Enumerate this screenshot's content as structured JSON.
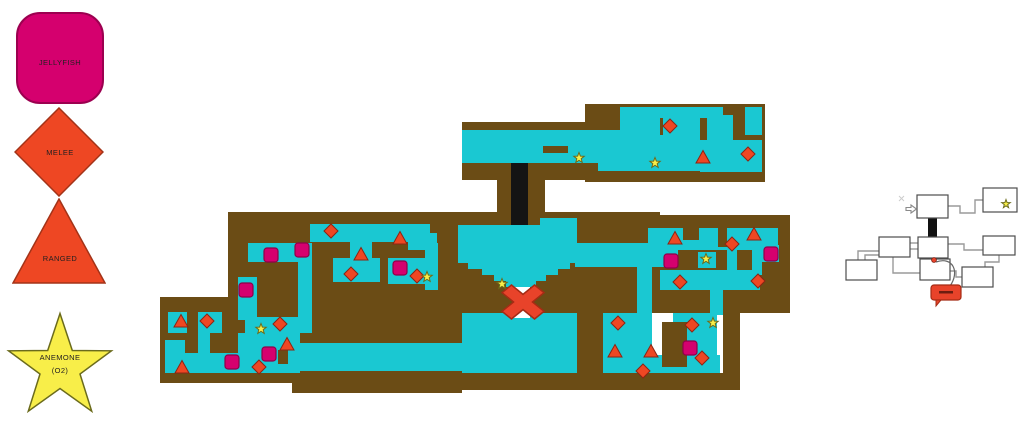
{
  "legend": {
    "items": [
      {
        "id": "jellyfish",
        "label": "JELLYFISH",
        "shape": "rounded-square",
        "color_key": "jellyfish"
      },
      {
        "id": "melee",
        "label": "MELEE",
        "shape": "diamond",
        "color_key": "enemy"
      },
      {
        "id": "ranged",
        "label": "RANGED",
        "shape": "triangle",
        "color_key": "enemy"
      },
      {
        "id": "anemone",
        "label": "ANEMONE",
        "sublabel": "(O2)",
        "shape": "star",
        "color_key": "anemone"
      }
    ]
  },
  "map": {
    "palette": {
      "land": "#6b4c15",
      "water": "#1ac8d2",
      "shaft": "#141414",
      "hole": "#ffffff",
      "jellyfish": "#d5006e",
      "jellyfish_border": "#8e0048",
      "enemy": "#ee4723",
      "enemy_border": "#8c2413",
      "anemone": "#f8ee49",
      "anemone_border": "#6b6b1c",
      "boss": "#e8432a",
      "boss_border": "#a52b14",
      "box_border": "#4d4d4d",
      "connector": "#9a9a9a"
    },
    "land": [
      [
        462,
        122,
        138,
        58
      ],
      [
        585,
        104,
        180,
        78
      ],
      [
        497,
        163,
        48,
        62
      ],
      [
        435,
        212,
        225,
        101
      ],
      [
        635,
        215,
        155,
        98
      ],
      [
        228,
        212,
        232,
        101
      ],
      [
        160,
        297,
        140,
        86
      ],
      [
        300,
        313,
        162,
        30
      ],
      [
        292,
        371,
        170,
        22
      ],
      [
        460,
        373,
        280,
        17
      ],
      [
        577,
        313,
        26,
        60
      ],
      [
        723,
        313,
        17,
        60
      ],
      [
        650,
        290,
        138,
        23
      ]
    ],
    "water": [
      [
        462,
        130,
        138,
        33
      ],
      [
        598,
        130,
        24,
        41
      ],
      [
        598,
        152,
        74,
        19
      ],
      [
        620,
        107,
        20,
        45
      ],
      [
        620,
        107,
        103,
        11
      ],
      [
        640,
        115,
        20,
        38
      ],
      [
        660,
        135,
        40,
        36
      ],
      [
        663,
        115,
        37,
        25
      ],
      [
        745,
        107,
        17,
        28
      ],
      [
        700,
        140,
        62,
        32
      ],
      [
        707,
        115,
        26,
        30
      ],
      [
        540,
        218,
        37,
        7
      ],
      [
        458,
        225,
        119,
        38
      ],
      [
        468,
        263,
        102,
        6
      ],
      [
        482,
        269,
        76,
        6
      ],
      [
        494,
        275,
        52,
        6
      ],
      [
        506,
        281,
        30,
        6
      ],
      [
        425,
        243,
        13,
        47
      ],
      [
        575,
        243,
        103,
        24
      ],
      [
        637,
        267,
        15,
        106
      ],
      [
        462,
        313,
        115,
        60
      ],
      [
        275,
        343,
        190,
        28
      ],
      [
        248,
        243,
        62,
        19
      ],
      [
        298,
        243,
        14,
        90
      ],
      [
        238,
        277,
        19,
        43
      ],
      [
        310,
        224,
        120,
        18
      ],
      [
        408,
        233,
        29,
        17
      ],
      [
        333,
        258,
        47,
        24
      ],
      [
        350,
        242,
        22,
        22
      ],
      [
        388,
        258,
        44,
        26
      ],
      [
        168,
        312,
        54,
        21
      ],
      [
        198,
        333,
        12,
        20
      ],
      [
        165,
        340,
        20,
        33
      ],
      [
        185,
        353,
        53,
        20
      ],
      [
        238,
        333,
        62,
        40
      ],
      [
        245,
        317,
        55,
        21
      ],
      [
        603,
        313,
        49,
        60
      ],
      [
        603,
        355,
        117,
        18
      ],
      [
        673,
        313,
        44,
        60
      ],
      [
        710,
        290,
        13,
        25
      ],
      [
        648,
        228,
        130,
        22
      ],
      [
        698,
        252,
        18,
        16
      ],
      [
        762,
        245,
        17,
        17
      ],
      [
        660,
        270,
        100,
        20
      ],
      [
        727,
        250,
        10,
        25
      ],
      [
        752,
        240,
        10,
        35
      ]
    ],
    "intrusions": [
      [
        543,
        146,
        25,
        7
      ],
      [
        187,
        312,
        11,
        21
      ],
      [
        278,
        350,
        10,
        14
      ],
      [
        662,
        322,
        25,
        45
      ],
      [
        683,
        228,
        16,
        12
      ],
      [
        718,
        228,
        9,
        19
      ]
    ],
    "shaft": [
      511,
      163,
      17,
      62
    ],
    "holes": [
      [
        514,
        287,
        16,
        9
      ],
      [
        514,
        309,
        16,
        9
      ]
    ],
    "boss": {
      "x": 523,
      "y": 302,
      "rx": 21,
      "ry": 17
    },
    "markers": {
      "jellyfish": [
        [
          271,
          255
        ],
        [
          302,
          250
        ],
        [
          246,
          290
        ],
        [
          269,
          354
        ],
        [
          232,
          362
        ],
        [
          400,
          268
        ],
        [
          671,
          261
        ],
        [
          771,
          254
        ],
        [
          690,
          348
        ]
      ],
      "melee": [
        [
          331,
          231
        ],
        [
          351,
          274
        ],
        [
          417,
          276
        ],
        [
          280,
          324
        ],
        [
          207,
          321
        ],
        [
          259,
          367
        ],
        [
          670,
          126
        ],
        [
          748,
          154
        ],
        [
          618,
          323
        ],
        [
          643,
          371
        ],
        [
          692,
          325
        ],
        [
          702,
          358
        ],
        [
          732,
          244
        ],
        [
          758,
          281
        ],
        [
          680,
          282
        ]
      ],
      "ranged": [
        [
          400,
          238
        ],
        [
          361,
          254
        ],
        [
          181,
          321
        ],
        [
          182,
          367
        ],
        [
          287,
          344
        ],
        [
          703,
          157
        ],
        [
          675,
          238
        ],
        [
          754,
          234
        ],
        [
          615,
          351
        ],
        [
          651,
          351
        ]
      ],
      "anemone": [
        [
          579,
          158
        ],
        [
          655,
          163
        ],
        [
          502,
          284
        ],
        [
          427,
          277
        ],
        [
          261,
          329
        ],
        [
          713,
          323
        ],
        [
          706,
          259
        ]
      ]
    }
  },
  "diagram": {
    "boxes": [
      [
        917,
        195,
        31,
        23
      ],
      [
        983,
        188,
        34,
        24
      ],
      [
        918,
        237,
        30,
        21
      ],
      [
        920,
        259,
        30,
        21
      ],
      [
        879,
        237,
        31,
        20
      ],
      [
        846,
        260,
        31,
        20
      ],
      [
        983,
        236,
        32,
        19
      ],
      [
        962,
        267,
        31,
        20
      ]
    ],
    "black_link": [
      928,
      218,
      9,
      20
    ],
    "connectors": [
      [
        [
          948,
          206
        ],
        [
          960,
          206
        ],
        [
          960,
          213
        ],
        [
          975,
          213
        ],
        [
          975,
          200
        ],
        [
          983,
          200
        ]
      ],
      [
        [
          910,
          243
        ],
        [
          918,
          243
        ]
      ],
      [
        [
          910,
          249
        ],
        [
          918,
          249
        ]
      ],
      [
        [
          879,
          251
        ],
        [
          858,
          251
        ],
        [
          858,
          260
        ]
      ],
      [
        [
          879,
          255
        ],
        [
          865,
          255
        ],
        [
          865,
          260
        ]
      ],
      [
        [
          948,
          244
        ],
        [
          964,
          244
        ],
        [
          964,
          250
        ],
        [
          983,
          250
        ]
      ],
      [
        [
          999,
          255
        ],
        [
          999,
          262
        ],
        [
          985,
          262
        ],
        [
          985,
          267
        ]
      ],
      [
        [
          950,
          271
        ],
        [
          956,
          271
        ],
        [
          956,
          277
        ],
        [
          962,
          277
        ]
      ],
      [
        [
          893,
          257
        ],
        [
          893,
          273
        ],
        [
          920,
          273
        ]
      ]
    ],
    "arrow": {
      "x": 906,
      "y": 206
    },
    "star": {
      "x": 1006,
      "y": 204
    },
    "dot": {
      "x": 934,
      "y": 260
    },
    "leader": "M936,262 C953,256 960,272 950,286",
    "callout": {
      "x": 931,
      "y": 285,
      "w": 30,
      "h": 15
    },
    "faint_mark": {
      "x": 899,
      "y": 196
    }
  }
}
